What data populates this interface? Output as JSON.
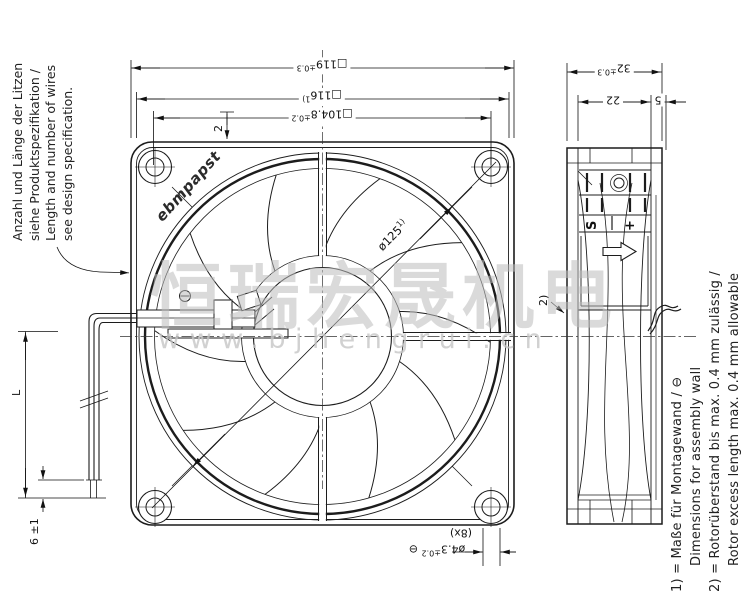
{
  "watermark": {
    "cn": "恒瑞宏晟机电",
    "url": "www.bjhengrui.cn"
  },
  "brand": {
    "logo": "ebmpapst"
  },
  "notes_left": {
    "lines": [
      "Anzahl und Länge der Litzen",
      "siehe Produktspezifikation /",
      "Length and number of wires",
      "see design specification."
    ]
  },
  "notes_bottom_right": {
    "line1": "1) = Maße für Montagewand / ⊖",
    "line2": "Dimensions for assembly wall",
    "line3": "2) = Rotorüberstand bis max. 0.4 mm zulässig /",
    "line4": "Rotor excess length max. 0.4 mm allowable"
  },
  "dimensions": {
    "outer_square": {
      "main": "□119",
      "tol": "±0.3"
    },
    "wall_square": {
      "main": "□116",
      "ref": "1)"
    },
    "hole_spacing": {
      "main": "□104.8",
      "tol": "±0.2"
    },
    "wire_offset": "2",
    "depth": {
      "main": "32",
      "tol": "±0.3"
    },
    "depth_sub1": "22",
    "depth_sub2": "5",
    "hole_dia": {
      "main": "ø4.3",
      "tol": "±0.2",
      "datum": "⊖",
      "count": "(8x)"
    },
    "opening_dia": {
      "main": "ø125",
      "ref": "1)"
    },
    "wire_length": "L",
    "strip_length": "6 ±1",
    "rotor_ref": "2)"
  },
  "side_view": {
    "terminal": {
      "s": "S",
      "plus": "+"
    }
  }
}
